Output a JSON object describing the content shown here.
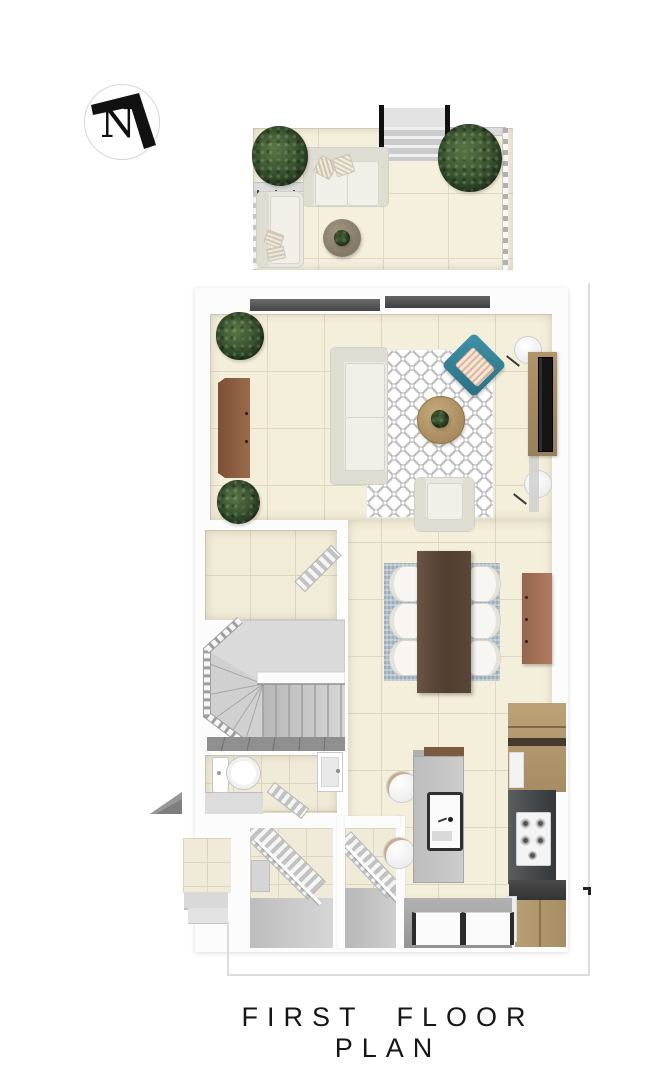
{
  "title": "FIRST FLOOR PLAN",
  "compass": {
    "label": "N",
    "icon": "north-arrow-icon",
    "pointing": "up-right"
  },
  "palette": {
    "floor_tile": "#f4efdb",
    "wall_white": "#fcfcfc",
    "terrace_tile": "#f5f0dd",
    "stair_gray": "#d7d7d7",
    "dark_step_band": "#8f8f8f",
    "dining_table_wood": "#503e30",
    "living_sideboard_wood": "#8a5b40",
    "dining_sideboard_wood": "#a06a52",
    "kitchen_cabinet_oak": "#b2996e",
    "kitchen_counter_dark": "#33373a",
    "island_gray": "#c2c2c2",
    "accent_teal": "#37859b",
    "rug_living": "#fefefe",
    "rug_dining_blue": "#b0bfc9",
    "plant_green": "#35502c",
    "boundary_line": "#dcdcdc",
    "title_color": "#161616"
  },
  "rooms_visible": [
    "terrace",
    "living-room",
    "dining-area",
    "kitchen",
    "staircase",
    "storage-room",
    "bathroom",
    "entry-hall",
    "porch"
  ],
  "furniture_visible": {
    "terrace": [
      "sofa",
      "lounge-chair",
      "round-coffee-table",
      "potted-plant",
      "potted-plant",
      "railing",
      "entry-steps"
    ],
    "living_room": [
      "sofa",
      "armchair",
      "teal-lounge-chair",
      "round-coffee-table",
      "patterned-rug",
      "sideboard",
      "tv-console",
      "tv",
      "side-table",
      "side-table",
      "potted-plant",
      "potted-plant"
    ],
    "dining": [
      "dining-table",
      "chair",
      "chair",
      "chair",
      "chair",
      "chair",
      "chair",
      "blue-rug",
      "sideboard"
    ],
    "kitchen": [
      "island-with-sink",
      "bar-stool",
      "bar-stool",
      "gas-hob",
      "wall-cabinets",
      "base-cabinet",
      "windows"
    ],
    "bathroom": [
      "toilet",
      "sink",
      "radiator"
    ]
  }
}
